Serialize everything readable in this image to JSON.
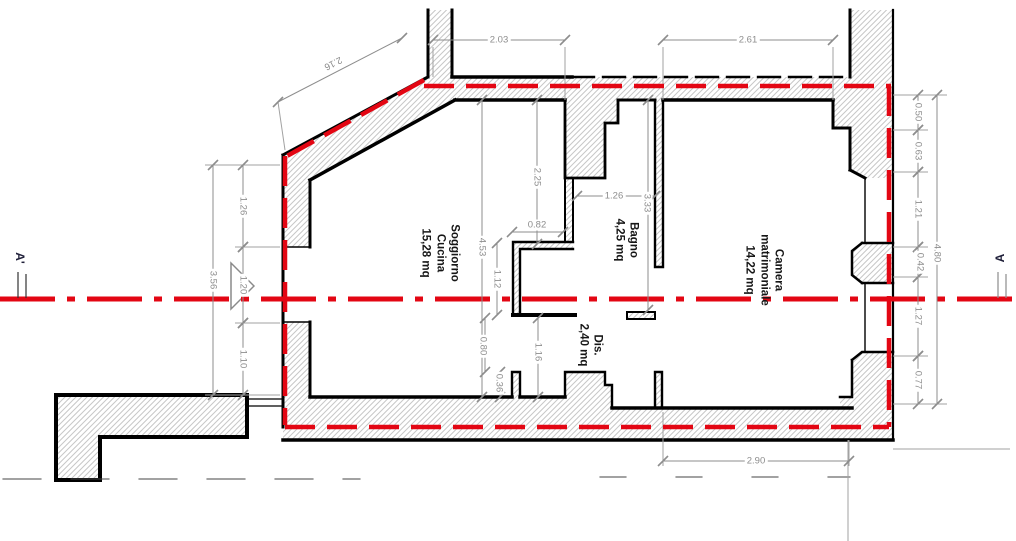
{
  "section": {
    "left_label": "A'",
    "right_label": "A"
  },
  "colors": {
    "section_red": "#e30613",
    "wall_outline": "#000000",
    "hatch_gray": "#c7c7c7",
    "dimension_gray": "#8d8d8d"
  },
  "rooms": [
    {
      "id": "soggiorno",
      "lines": [
        "Soggiorno",
        "Cucina"
      ],
      "area": "15,28 mq",
      "x": 440,
      "y": 253
    },
    {
      "id": "bagno",
      "lines": [
        "Bagno"
      ],
      "area": "4,25 mq",
      "x": 626,
      "y": 240
    },
    {
      "id": "dis",
      "lines": [
        "Dis."
      ],
      "area": "2,40 mq",
      "x": 590,
      "y": 345
    },
    {
      "id": "camera",
      "lines": [
        "Camera",
        "matrimoniale"
      ],
      "area": "14,22 mq",
      "x": 764,
      "y": 270
    }
  ],
  "dimensions": [
    {
      "value": "2.03",
      "x1": 433,
      "y1": 40,
      "x2": 565,
      "y2": 40,
      "lx": 499,
      "ly": 40,
      "rot": 0
    },
    {
      "value": "2.61",
      "x1": 663,
      "y1": 40,
      "x2": 833,
      "y2": 40,
      "lx": 748,
      "ly": 40,
      "rot": 0
    },
    {
      "value": "2.16",
      "x1": 278,
      "y1": 102,
      "x2": 402,
      "y2": 38,
      "lx": 333,
      "ly": 63,
      "rot": 153
    },
    {
      "value": "3.56",
      "x1": 213,
      "y1": 165,
      "x2": 213,
      "y2": 395,
      "lx": 213,
      "ly": 280,
      "rot": 90
    },
    {
      "value": "1.26",
      "x1": 243,
      "y1": 165,
      "x2": 243,
      "y2": 247,
      "lx": 243,
      "ly": 206,
      "rot": 90
    },
    {
      "value": "1.20",
      "x1": 243,
      "y1": 247,
      "x2": 243,
      "y2": 323,
      "lx": 243,
      "ly": 285,
      "rot": 90
    },
    {
      "value": "1.10",
      "x1": 243,
      "y1": 323,
      "x2": 243,
      "y2": 395,
      "lx": 243,
      "ly": 359,
      "rot": 90
    },
    {
      "value": "4.53",
      "x1": 482,
      "y1": 100,
      "x2": 482,
      "y2": 397,
      "lx": 482,
      "ly": 247,
      "rot": 90
    },
    {
      "value": "2.25",
      "x1": 537,
      "y1": 100,
      "x2": 537,
      "y2": 244,
      "lx": 537,
      "ly": 177,
      "rot": 90
    },
    {
      "value": "0.82",
      "x1": 512,
      "y1": 232,
      "x2": 563,
      "y2": 232,
      "lx": 537,
      "ly": 225,
      "rot": 0
    },
    {
      "value": "1.12",
      "x1": 497,
      "y1": 243,
      "x2": 497,
      "y2": 315,
      "lx": 497,
      "ly": 279,
      "rot": 90
    },
    {
      "value": "0.80",
      "x1": 485,
      "y1": 318,
      "x2": 485,
      "y2": 372,
      "lx": 483,
      "ly": 346,
      "rot": 90
    },
    {
      "value": "0.36",
      "x1": 500,
      "y1": 372,
      "x2": 500,
      "y2": 397,
      "lx": 499,
      "ly": 383,
      "rot": 90
    },
    {
      "value": "1.16",
      "x1": 538,
      "y1": 318,
      "x2": 538,
      "y2": 397,
      "lx": 538,
      "ly": 352,
      "rot": 90
    },
    {
      "value": "1.26",
      "x1": 577,
      "y1": 196,
      "x2": 655,
      "y2": 196,
      "lx": 614,
      "ly": 196,
      "rot": 0
    },
    {
      "value": "3.33",
      "x1": 648,
      "y1": 100,
      "x2": 648,
      "y2": 310,
      "lx": 647,
      "ly": 203,
      "rot": 90
    },
    {
      "value": "2.90",
      "x1": 663,
      "y1": 461,
      "x2": 849,
      "y2": 461,
      "lx": 756,
      "ly": 461,
      "rot": 0
    },
    {
      "value": "4.80",
      "x1": 937,
      "y1": 95,
      "x2": 937,
      "y2": 404,
      "lx": 937,
      "ly": 253,
      "rot": 90
    },
    {
      "value": "0.50",
      "x1": 918,
      "y1": 95,
      "x2": 918,
      "y2": 130,
      "lx": 918,
      "ly": 112,
      "rot": 90
    },
    {
      "value": "0.63",
      "x1": 918,
      "y1": 130,
      "x2": 918,
      "y2": 172,
      "lx": 918,
      "ly": 151,
      "rot": 90
    },
    {
      "value": "1.21",
      "x1": 918,
      "y1": 172,
      "x2": 918,
      "y2": 247,
      "lx": 918,
      "ly": 209,
      "rot": 90
    },
    {
      "value": "0.42",
      "x1": 918,
      "y1": 247,
      "x2": 918,
      "y2": 277,
      "lx": 920,
      "ly": 262,
      "rot": 90
    },
    {
      "value": "1.27",
      "x1": 918,
      "y1": 277,
      "x2": 918,
      "y2": 356,
      "lx": 918,
      "ly": 316,
      "rot": 90
    },
    {
      "value": "0.77",
      "x1": 918,
      "y1": 356,
      "x2": 918,
      "y2": 404,
      "lx": 918,
      "ly": 380,
      "rot": 90
    }
  ]
}
